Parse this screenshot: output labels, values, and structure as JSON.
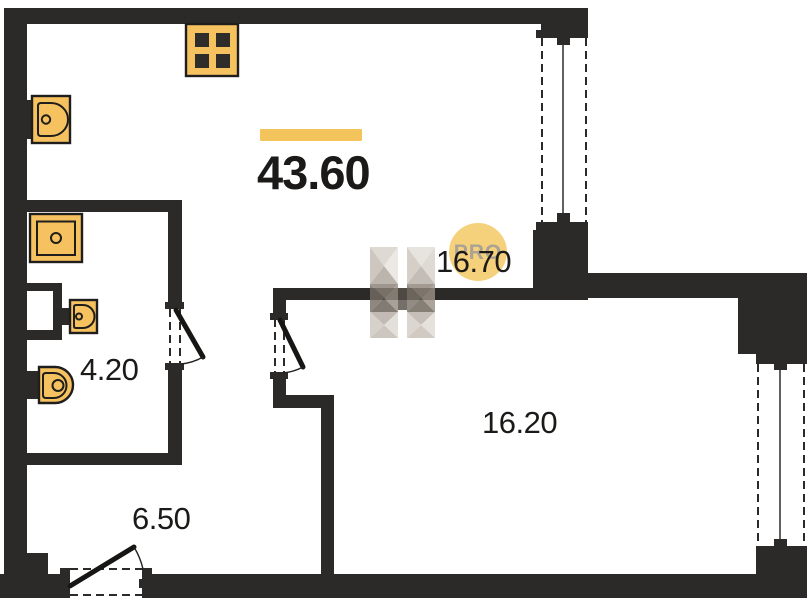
{
  "plan": {
    "type": "apartment-floor-plan",
    "total_area": "43.60",
    "rooms": [
      {
        "id": "kitchen-living",
        "area": "16.70"
      },
      {
        "id": "room",
        "area": "16.20"
      },
      {
        "id": "bathroom",
        "area": "4.20"
      },
      {
        "id": "hallway",
        "area": "6.50"
      }
    ],
    "watermark": {
      "badge": "PRO",
      "logo": "faceted-H-logo"
    },
    "fixtures": [
      "stove-icon",
      "kitchen-sink-icon",
      "washing-machine-icon",
      "bathroom-sink-icon",
      "toilet-icon"
    ],
    "openings": {
      "windows": 2,
      "doors": 3
    }
  },
  "colors": {
    "wall": "#2B2A28",
    "fixture_fill": "#F6C25F",
    "fixture_stroke": "#1F1E1C",
    "accent_bar": "#F4C45C",
    "badge_fill": "#F6CF75",
    "badge_text": "#A29D96",
    "label_text": "#1B1A18",
    "background": "#FFFFFF"
  }
}
